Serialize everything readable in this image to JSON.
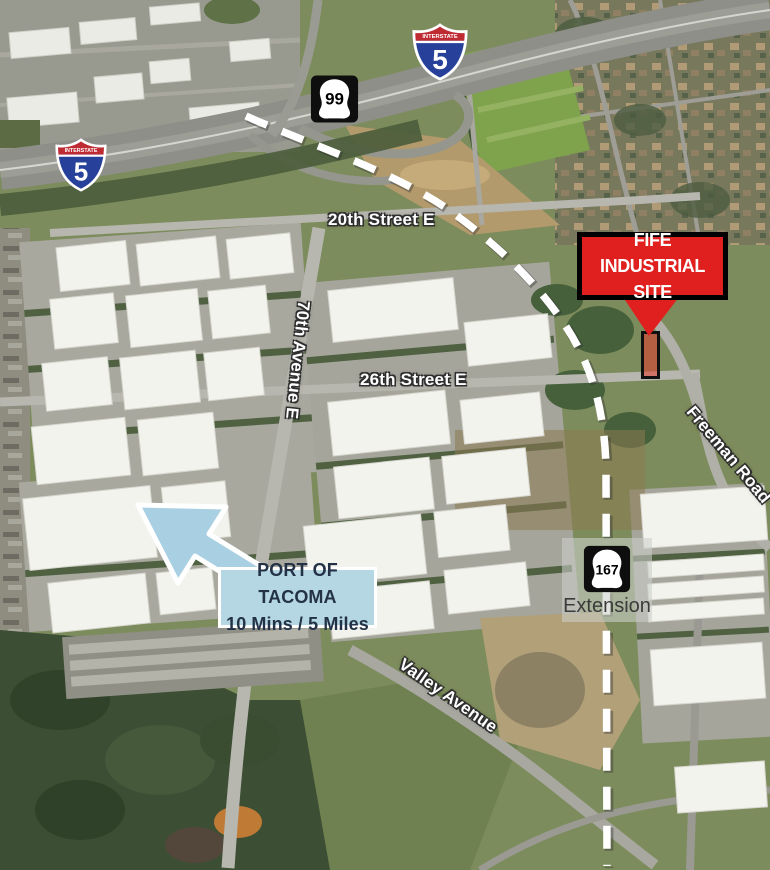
{
  "colors": {
    "site_red": "#e0201f",
    "callout_blue": "#b5d7e3",
    "arrow_blue": "#a9d0e2",
    "route_dash": "#ffffff",
    "interstate_blue": "#27409a",
    "interstate_red": "#bf2b33"
  },
  "shields": {
    "banner": "INTERSTATE",
    "i5_top": "5",
    "i5_left": "5",
    "sr99": "99",
    "sr167": "167"
  },
  "streets": {
    "s20": "20th Street E",
    "s26": "26th Street E",
    "ave70": "70th Avenue E",
    "freeman": "Freeman Road",
    "valley": "Valley Avenue"
  },
  "callouts": {
    "site": {
      "line1": "FIFE INDUSTRIAL",
      "line2": "SITE"
    },
    "port": {
      "line1": "PORT OF TACOMA",
      "line2": "10 Mins / 5 Miles"
    },
    "extension": {
      "label": "Extension"
    }
  }
}
